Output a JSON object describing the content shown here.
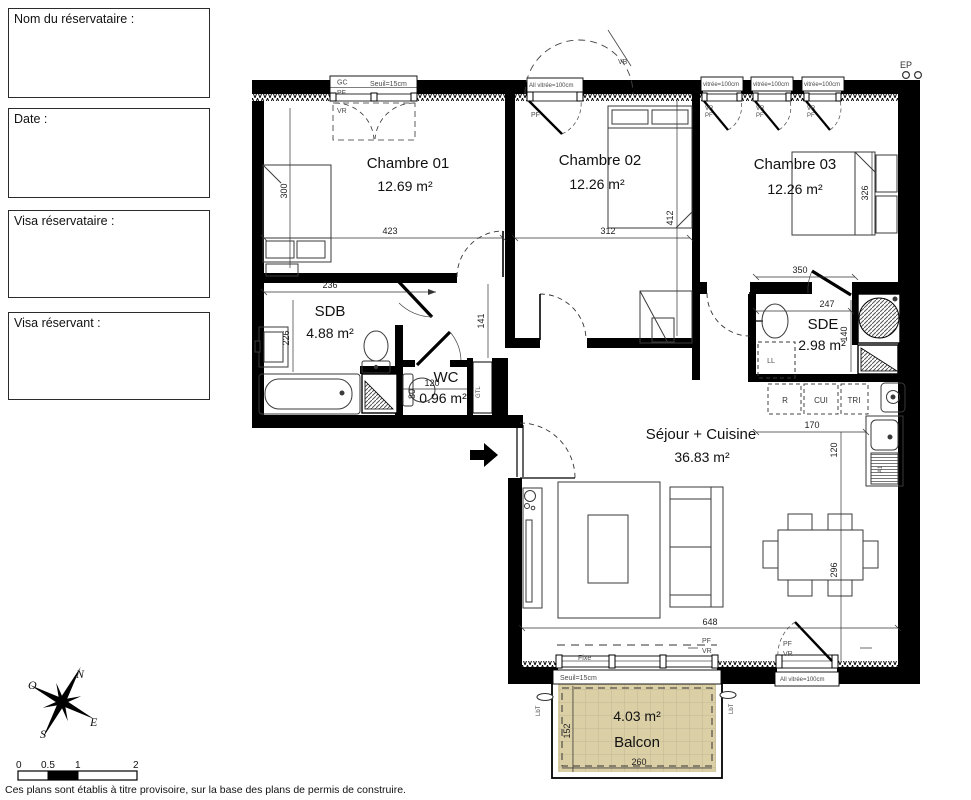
{
  "form": {
    "boxes": [
      {
        "label": "Nom du réservataire :"
      },
      {
        "label": "Date :"
      },
      {
        "label": "Visa réservataire :"
      },
      {
        "label": "Visa réservant :"
      }
    ]
  },
  "rooms": {
    "chambre01": {
      "name": "Chambre 01",
      "area": "12.69 m²"
    },
    "chambre02": {
      "name": "Chambre 02",
      "area": "12.26 m²"
    },
    "chambre03": {
      "name": "Chambre 03",
      "area": "12.26 m²"
    },
    "sdb": {
      "name": "SDB",
      "area": "4.88 m²"
    },
    "wc": {
      "name": "WC",
      "area": "0.96 m²"
    },
    "sde": {
      "name": "SDE",
      "area": "2.98 m²"
    },
    "sejour": {
      "name": "Séjour + Cuisine",
      "area": "36.83 m²"
    },
    "balcon": {
      "name": "Balcon",
      "area": "4.03 m²"
    }
  },
  "dims": {
    "d300": "300",
    "d423": "423",
    "d236": "236",
    "d226": "226",
    "d312": "312",
    "d412": "412",
    "d141": "141",
    "d120": "120",
    "d80": "80",
    "d350": "350",
    "d247": "247",
    "d140": "140",
    "d326": "326",
    "d170": "170",
    "d296": "296",
    "d648": "648",
    "d152": "152",
    "d260": "260"
  },
  "labels": {
    "gc": "GC",
    "seuil": "Seuil=15cm",
    "pf": "PF",
    "vr": "VR",
    "vb": "VB",
    "vitree": "All vitrée=100cm",
    "vitree_small": "vitrée=100cm",
    "ep": "EP",
    "gtl": "GTL",
    "ll": "LL",
    "r": "R",
    "cui": "CUI",
    "tri": "TRI",
    "a1": "A1",
    "fixe": "Fixe",
    "lbt": "LbT"
  },
  "compass": {
    "n": "N",
    "e": "E",
    "s": "S",
    "o": "O"
  },
  "scalebar": {
    "t0": "0",
    "t05": "0.5",
    "t1": "1",
    "t2": "2"
  },
  "footer": "Ces plans sont établis à titre provisoire, sur la base des plans de permis de construire.",
  "colors": {
    "wall": "#000000",
    "balcony_fill": "#dbcfa6"
  }
}
